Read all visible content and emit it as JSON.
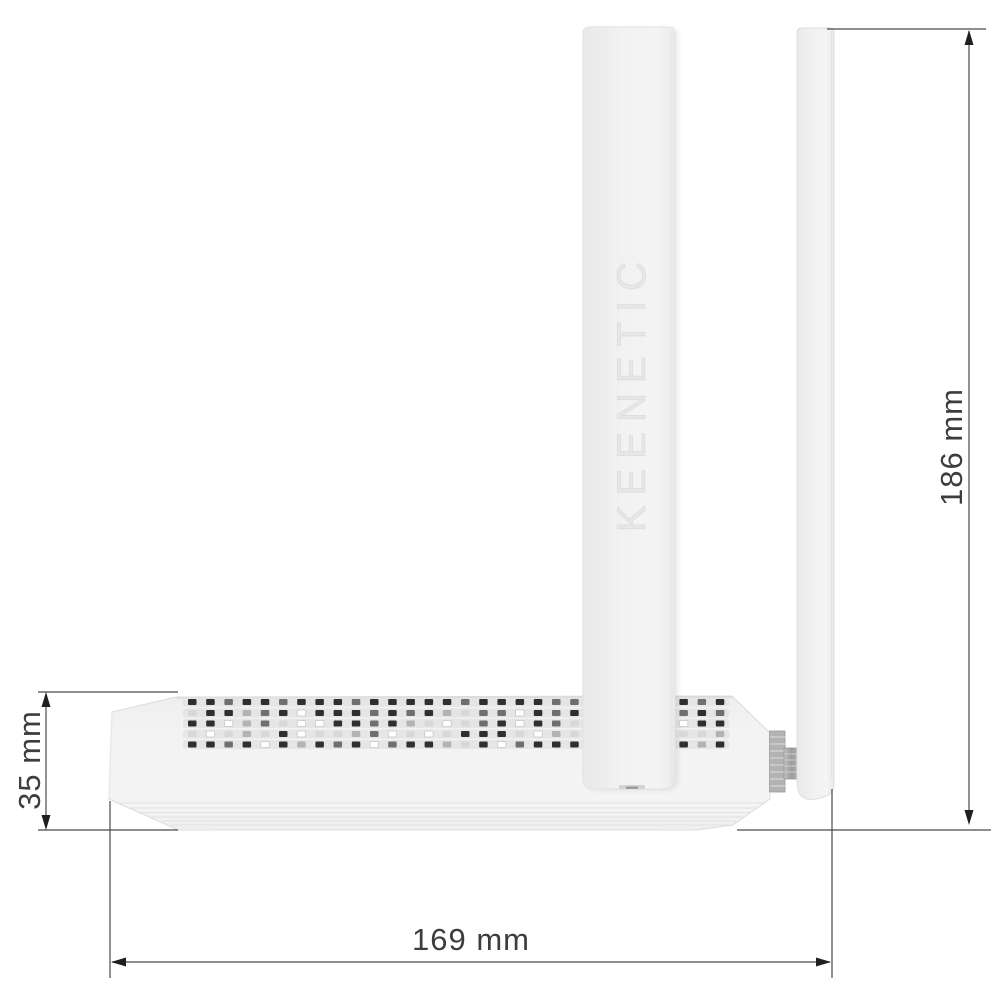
{
  "figure": {
    "type": "product-dimension-diagram",
    "subject": "Keenetic wireless router, side view with two antennas",
    "brand_label": "KEENETIC"
  },
  "annotations": {
    "overall_height": {
      "label": "186 mm",
      "value": 186,
      "unit": "mm"
    },
    "body_height": {
      "label": "35 mm",
      "value": 35,
      "unit": "mm"
    },
    "body_depth": {
      "label": "169 mm",
      "value": 169,
      "unit": "mm"
    }
  },
  "colors": {
    "background": "#ffffff",
    "annotation_line": "#4a4a4a",
    "annotation_text": "#3d3d3d",
    "arrow_fill": "#1f1f1f",
    "body_fill": "#f2f2f2",
    "antenna_fill": "#f0f0f0",
    "edge_light": "#dcdcdc",
    "emboss_text": "#e7e7e7",
    "hinge_gray": "#a6a6a6",
    "vent_track": "#e3e3e3"
  },
  "vents": {
    "x_start": 188,
    "pitch": 18.2,
    "hole_w": 8.5,
    "hole_h": 6,
    "track_color": "#e3e3e3",
    "palette": {
      "d": "#2f2f2f",
      "m": "#6f6f6f",
      "l": "#b3b3b3",
      "p": "#d8d8d8",
      "w": "#ffffff"
    },
    "rows": [
      {
        "y": 699,
        "pattern": "ddmddmdddmdddddmddddmmddddddmd"
      },
      {
        "y": 710,
        "pattern": "pddlmdwdddmdmdlpmmwdmdpmlddmdm"
      },
      {
        "y": 720.5,
        "pattern": "ddwlmpwwddmdlpwpmdwdmpwlddmwdd"
      },
      {
        "y": 731,
        "pattern": "pwplpdwpplmwpwpdddpwlpwppdwppl"
      },
      {
        "y": 741.5,
        "pattern": "ddmdwdldmdwmddlpdwmdddpdwdmdld"
      }
    ]
  }
}
